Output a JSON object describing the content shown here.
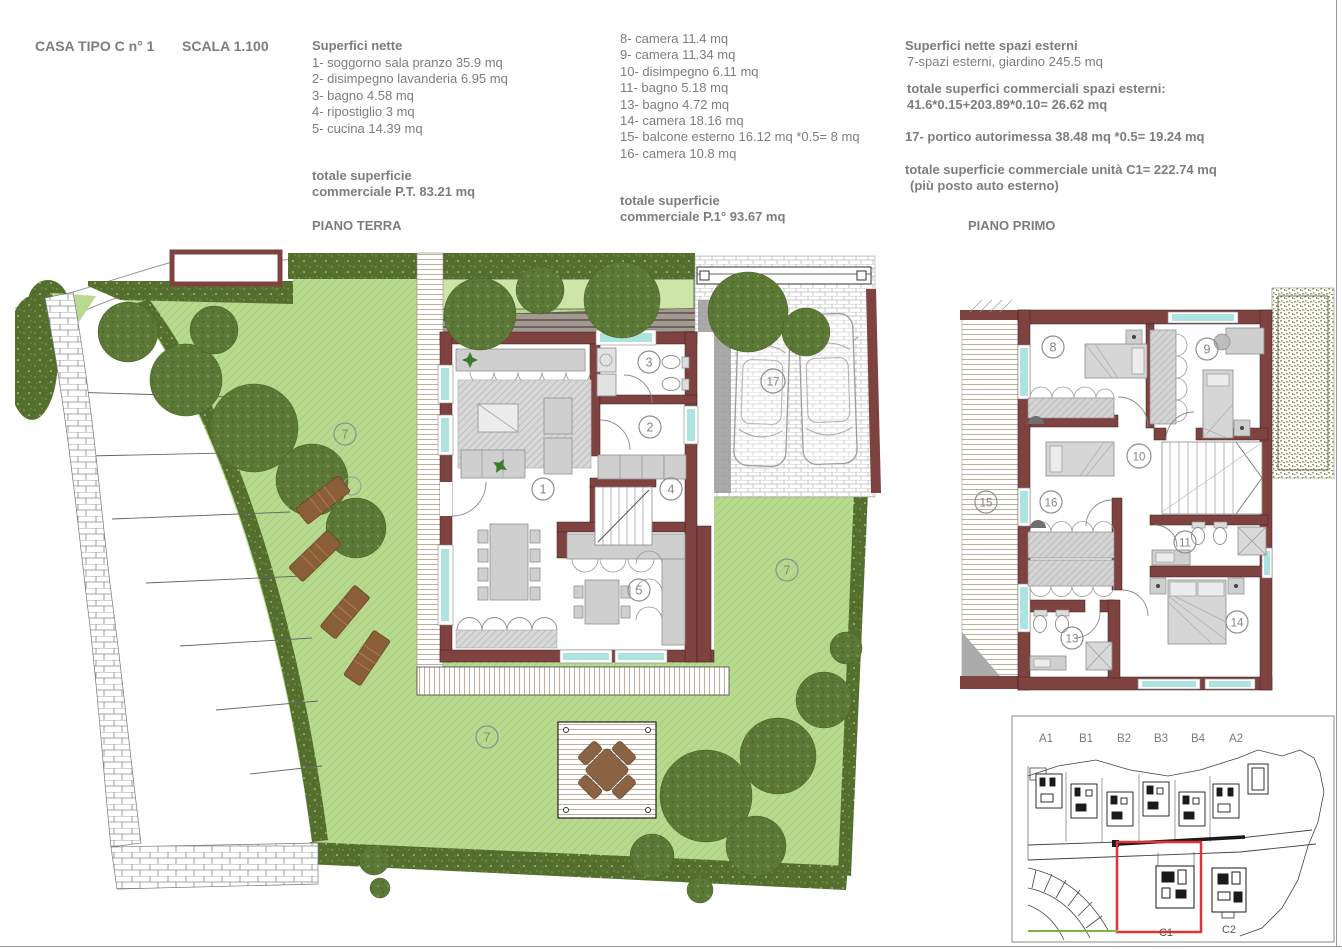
{
  "header": {
    "title": "CASA TIPO C n° 1",
    "scale": "SCALA 1.100"
  },
  "legends": {
    "ground": {
      "heading": "Superfici nette",
      "items": [
        "1- soggorno sala pranzo 35.9 mq",
        "2- disimpegno lavanderia 6.95 mq",
        "3- bagno 4.58 mq",
        "4- ripostiglio 3 mq",
        "5- cucina 14.39 mq"
      ],
      "total_line1": "totale superficie",
      "total_line2": "commerciale P.T. 83.21 mq",
      "floor_label": "PIANO TERRA"
    },
    "first": {
      "items": [
        "8- camera 11.4 mq",
        "9- camera 11.34 mq",
        "10- disimpegno 6.11 mq",
        "11- bagno 5.18 mq",
        "13- bagno 4.72 mq",
        "14- camera 18.16 mq",
        "15- balcone esterno 16.12 mq *0.5= 8 mq",
        "16- camera 10.8 mq"
      ],
      "total_line1": "totale superficie",
      "total_line2": "commerciale P.1° 93.67 mq",
      "floor_label": "PIANO PRIMO"
    },
    "external": {
      "heading": "Superfici nette spazi esterni",
      "garden_line": "7-spazi esterni, giardino 245.5 mq",
      "total_heading": "totale superfici commerciali spazi esterni:",
      "total_formula": "41.6*0.15+203.89*0.10= 26.62 mq",
      "portico_line": "17- portico autorimessa 38.48 mq *0.5= 19.24 mq",
      "unit_total": "totale superficie commerciale unità C1= 222.74 mq",
      "unit_total_note": "(più posto auto esterno)"
    }
  },
  "plans": {
    "ground": {
      "labels": {
        "living": "1",
        "hall": "2",
        "bath": "3",
        "storage": "4",
        "kitchen": "5",
        "garden_a": "7",
        "garden_b": "7",
        "garden_c": "7",
        "carport": "17"
      }
    },
    "first": {
      "labels": {
        "camera8": "8",
        "camera9": "9",
        "disimpegno10": "10",
        "bagno11": "11",
        "bagno13": "13",
        "camera14": "14",
        "balcone15": "15",
        "camera16": "16"
      }
    }
  },
  "site_key": {
    "units": [
      "A1",
      "B1",
      "B2",
      "B3",
      "B4",
      "A2"
    ],
    "c1": "C1",
    "c2": "C2"
  },
  "colors": {
    "wall": "#7e4340",
    "lawn": "#b7da8e",
    "hedge": "#546e2d",
    "tree": "#5c7836",
    "window_glass": "#aee4e0",
    "furniture": "#cfcfcf",
    "lounger": "#8a5f38",
    "pergola_table": "#8a6345",
    "highlight_red": "#e03333",
    "site_green_line": "#7cb342",
    "text_gray": "#7d7d7d"
  }
}
